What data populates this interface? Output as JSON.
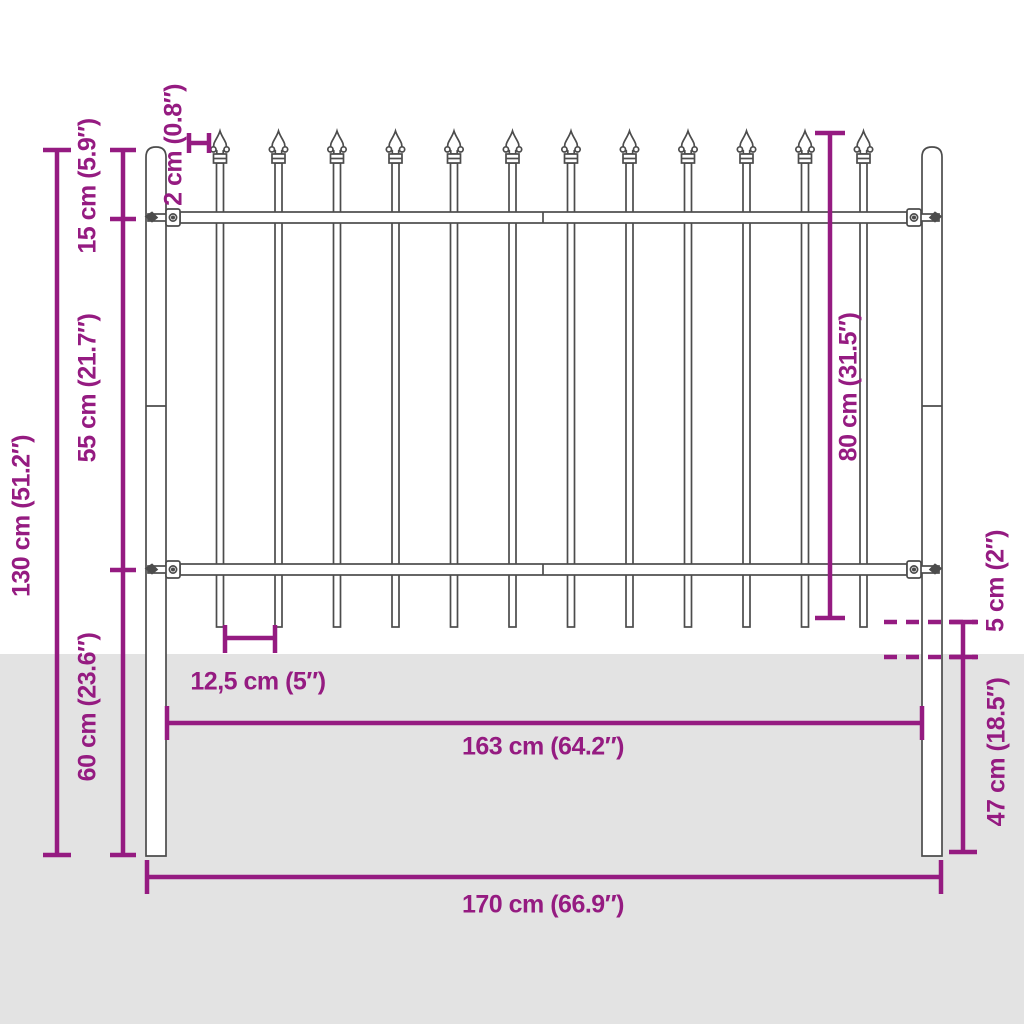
{
  "diagram": {
    "type": "fence-dimension-diagram",
    "colors": {
      "dimension": "#951b81",
      "outline": "#4c4c4c",
      "ground": "#e3e3e3",
      "background": "#ffffff"
    },
    "labels": {
      "height_total": "130 cm (51.2″)",
      "top_offset": "15 cm (5.9″)",
      "picket_width": "2 cm (0.8″)",
      "rail_gap": "55 cm (21.7″)",
      "below_rail": "60 cm (23.6″)",
      "panel_height": "80 cm (31.5″)",
      "ground_clearance": "5 cm (2″)",
      "buried_depth": "47 cm (18.5″)",
      "picket_spacing": "12,5 cm (5″)",
      "panel_width": "163 cm (64.2″)",
      "total_width": "170 cm (66.9″)"
    },
    "fence": {
      "picket_count": 12,
      "post_count": 2,
      "rail_count": 2
    }
  }
}
